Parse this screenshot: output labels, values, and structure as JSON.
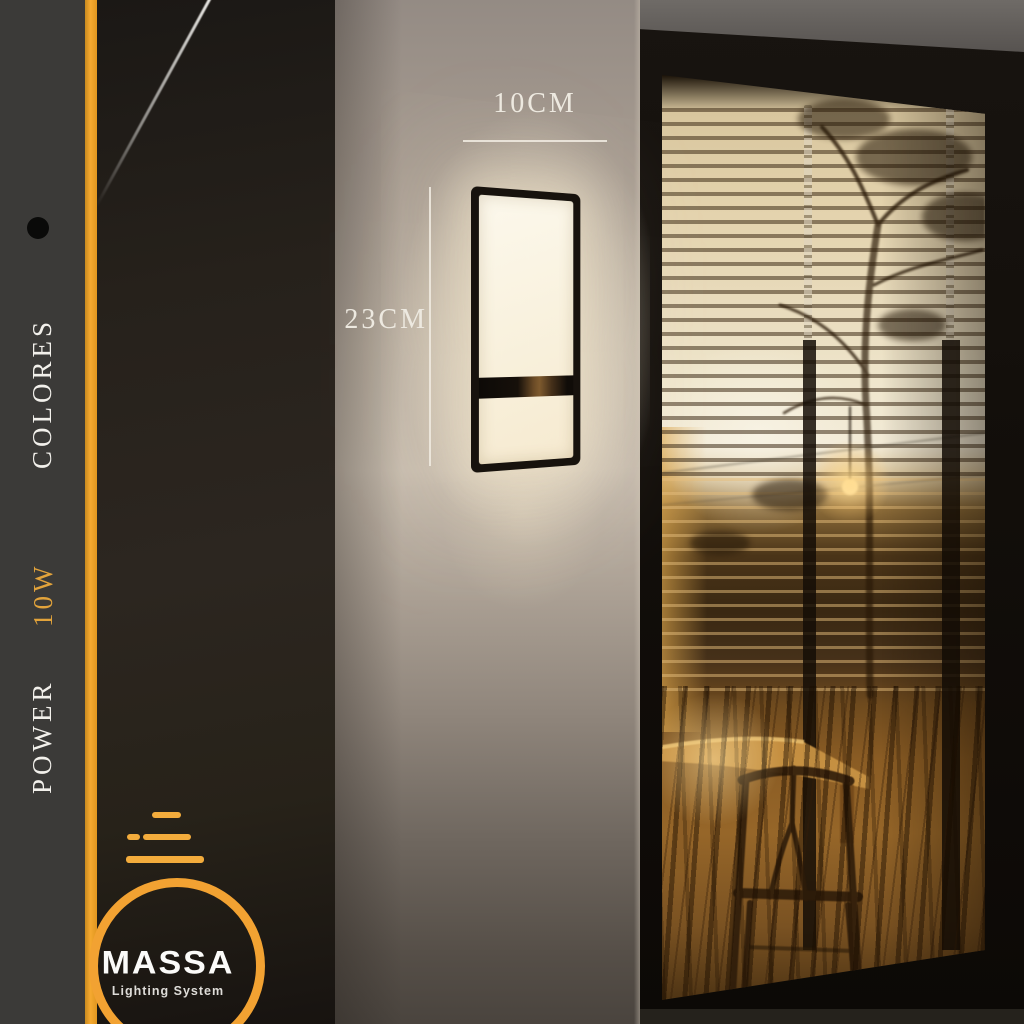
{
  "colors": {
    "accent_orange": "#F2A232",
    "sidebar_dark": "#3B3A38",
    "lamp_glow": "#F7EDD6",
    "annotation_text": "#EDE9E0"
  },
  "sidebar": {
    "colores_label": "COLORES",
    "power_label": "POWER",
    "power_value": "10W",
    "bullet_icon": "black-dot"
  },
  "dimensions": {
    "width_label": "10CM",
    "height_label": "23CM"
  },
  "logo": {
    "brand": "MASSA",
    "tagline": "Lighting System",
    "mark_icon": "bulb-circle-with-beam-lines"
  },
  "scene": {
    "product": "rectangular-led-wall-sconce",
    "setting": "building-corner-with-blinds-window-at-dusk"
  }
}
